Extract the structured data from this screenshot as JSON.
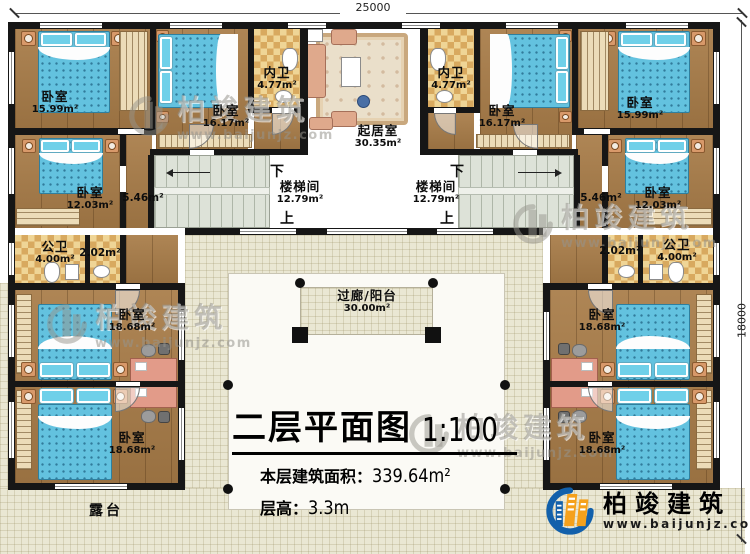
{
  "drawing": {
    "type": "architectural-floor-plan",
    "sheet_title": "二层平面图",
    "scale": "1:100"
  },
  "dimensions": {
    "top_width": "25000",
    "right_height": "18000"
  },
  "rooms": {
    "bedroom_top_left": {
      "name": "卧室",
      "area": "15.99m²"
    },
    "bedroom_top_right": {
      "name": "卧室",
      "area": "15.99m²"
    },
    "bedroom_mid_top_left": {
      "name": "卧室",
      "area": "16.17m²"
    },
    "bedroom_mid_top_right": {
      "name": "卧室",
      "area": "16.17m²"
    },
    "ensuite_bath_left": {
      "name": "内卫",
      "area": "4.77m²"
    },
    "ensuite_bath_right": {
      "name": "内卫",
      "area": "4.77m²"
    },
    "living_room": {
      "name": "起居室",
      "area": "30.35m²"
    },
    "stairwell_left": {
      "name": "楼梯间",
      "area": "12.79m²",
      "down": "下",
      "up": "上"
    },
    "stairwell_right": {
      "name": "楼梯间",
      "area": "12.79m²",
      "down": "下",
      "up": "上"
    },
    "bedroom_left": {
      "name": "卧室",
      "area": "12.03m²"
    },
    "bedroom_right": {
      "name": "卧室",
      "area": "12.03m²"
    },
    "hallway_left": {
      "area": "5.46m²"
    },
    "hallway_right": {
      "area": "5.46m²"
    },
    "public_bath_left": {
      "name": "公卫",
      "area": "4.00m²"
    },
    "public_bath_right": {
      "name": "公卫",
      "area": "4.00m²"
    },
    "washroom_left": {
      "area": "2.02m²"
    },
    "washroom_right": {
      "area": "2.02m²"
    },
    "bedroom_wing_left_upper": {
      "name": "卧室",
      "area": "18.68m²"
    },
    "bedroom_wing_left_lower": {
      "name": "卧室",
      "area": "18.68m²"
    },
    "bedroom_wing_right_upper": {
      "name": "卧室",
      "area": "18.68m²"
    },
    "bedroom_wing_right_lower": {
      "name": "卧室",
      "area": "18.68m²"
    },
    "corridor_balcony": {
      "name": "过廊/阳台",
      "area": "30.00m²"
    },
    "terrace": {
      "name": "露台"
    }
  },
  "title_block": {
    "title": "二层平面图",
    "scale": "1:100",
    "area_label": "本层建筑面积：",
    "area_value": "339.64m²",
    "height_label": "层高：",
    "height_value": "3.3m"
  },
  "logo": {
    "name": "柏竣建筑",
    "url": "www.baijunjz.com"
  },
  "watermark": {
    "name": "柏竣建筑",
    "url": "www.baijunjz.com"
  },
  "colors": {
    "wall": "#161616",
    "wood_floor": "#a87c48",
    "tile_floor": "#efd596",
    "tile_check": "#d8a95f",
    "terrace_floor": "#eae7d3",
    "bed": "#63c2df",
    "stair_floor": "#dde2d8",
    "sofa": "#dfa98c",
    "logo_blue": "#1260ab",
    "logo_orange": "#f5a11c"
  }
}
